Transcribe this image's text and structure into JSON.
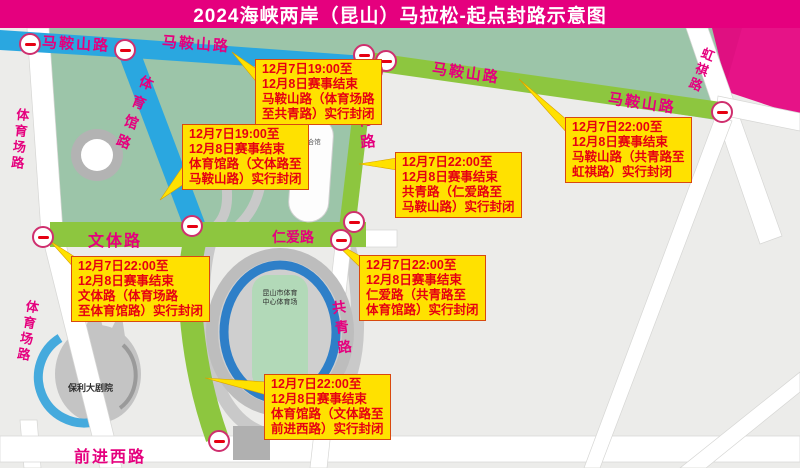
{
  "title": "2024海峡两岸（昆山）马拉松-起点封路示意图",
  "colors": {
    "banner": "#e5007e",
    "road_label": "#e5007e",
    "closed_route_green": "#8dc63f",
    "open_road_blue": "#2aa7e0",
    "park_green": "#9cc5a9",
    "callout_bg": "#ffe100",
    "callout_text": "#e60012",
    "sign_ring": "#cf2f6e",
    "sign_bar": "#e60012"
  },
  "roads": {
    "maanshan_blue_west": "马鞍山路",
    "maanshan_blue_east": "马鞍山路",
    "maanshan_green_west": "马鞍山路",
    "maanshan_green_east": "马鞍山路",
    "tiyuguan": "体育馆路",
    "gongqing_north": "共青路",
    "gongqing_south": "共青路",
    "tiyuchang_north": "体育场路",
    "tiyuchang_south": "体育场路",
    "wenti": "文体路",
    "renai": "仁爱路",
    "qianjinxi": "前进西路",
    "hongqi": "虹祺路"
  },
  "buildings": {
    "stadium_line1": "昆山市体育",
    "stadium_line2": "中心体育场",
    "gym": "综合馆",
    "theater": "保利大剧院"
  },
  "callouts": [
    {
      "lines": [
        "12月7日19:00至",
        "12月8日赛事结束",
        "马鞍山路（体育场路",
        "至共青路）实行封闭"
      ]
    },
    {
      "lines": [
        "12月7日19:00至",
        "12月8日赛事结束",
        "体育馆路（文体路至",
        "马鞍山路）实行封闭"
      ]
    },
    {
      "lines": [
        "12月7日22:00至",
        "12月8日赛事结束",
        "马鞍山路（共青路至",
        "虹祺路）实行封闭"
      ]
    },
    {
      "lines": [
        "12月7日22:00至",
        "12月8日赛事结束",
        "共青路（仁爱路至",
        "马鞍山路）实行封闭"
      ]
    },
    {
      "lines": [
        "12月7日22:00至",
        "12月8日赛事结束",
        "文体路（体育场路",
        "至体育馆路）实行封闭"
      ]
    },
    {
      "lines": [
        "12月7日22:00至",
        "12月8日赛事结束",
        "仁爱路（共青路至",
        "体育馆路）实行封闭"
      ]
    },
    {
      "lines": [
        "12月7日22:00至",
        "12月8日赛事结束",
        "体育馆路（文体路至",
        "前进西路）实行封闭"
      ]
    }
  ]
}
